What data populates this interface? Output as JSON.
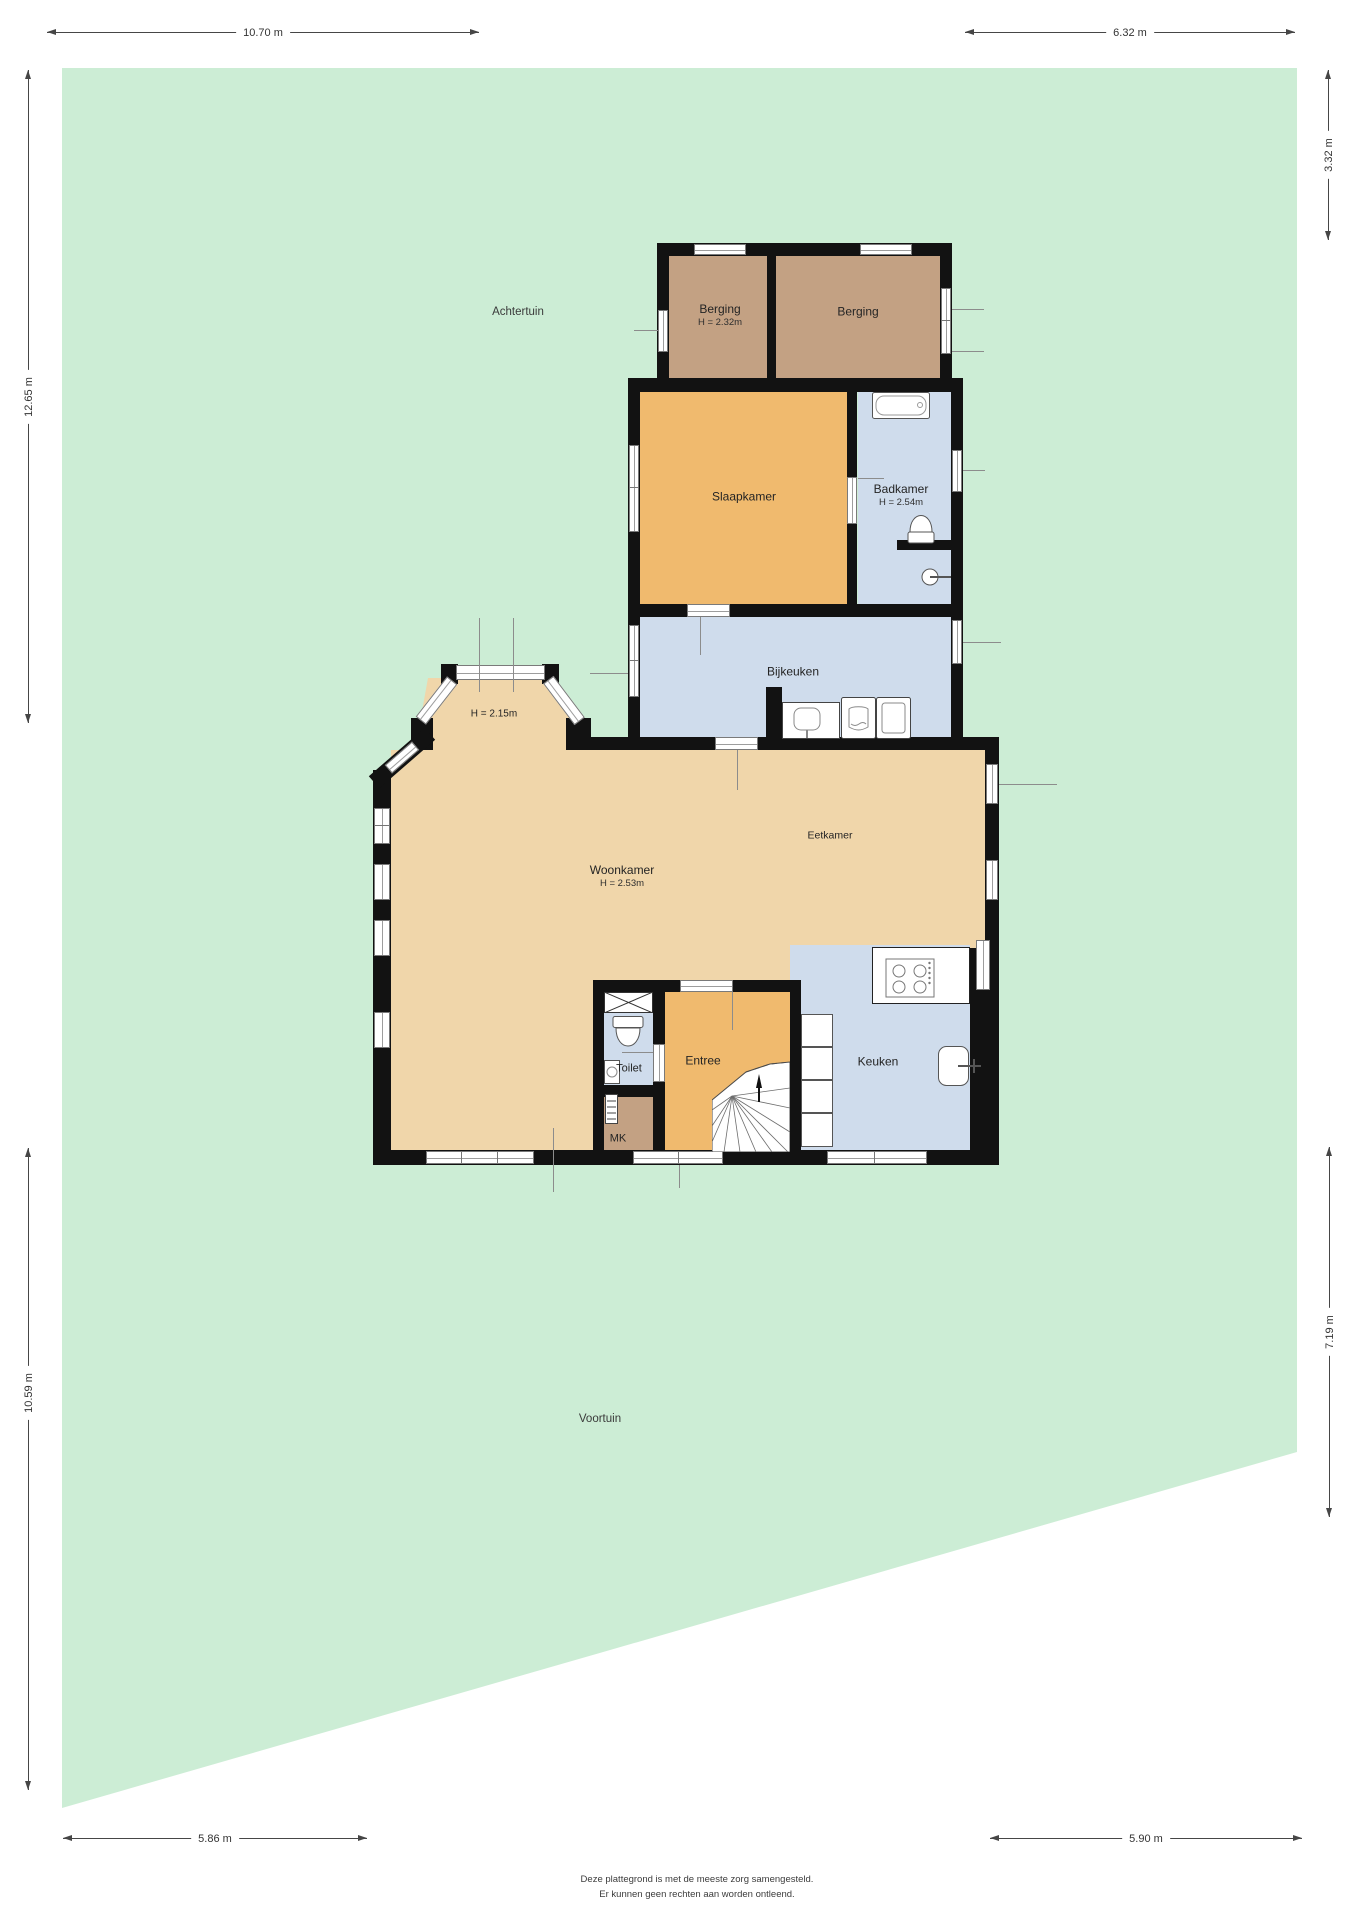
{
  "dimensions": {
    "top_left": "10.70 m",
    "top_right": "6.32 m",
    "left_upper": "12.65 m",
    "left_lower": "10.59 m",
    "right_upper": "3.32 m",
    "right_lower": "7.19 m",
    "bottom_left": "5.86 m",
    "bottom_right": "5.90 m"
  },
  "garden": {
    "back_label": "Achtertuin",
    "front_label": "Voortuin",
    "color": "#ccedd5"
  },
  "rooms": {
    "berging_left": {
      "name": "Berging",
      "height": "H = 2.32m"
    },
    "berging_right": {
      "name": "Berging"
    },
    "slaapkamer": {
      "name": "Slaapkamer"
    },
    "badkamer": {
      "name": "Badkamer",
      "height": "H = 2.54m"
    },
    "bijkeuken": {
      "name": "Bijkeuken"
    },
    "erker": {
      "height": "H = 2.15m"
    },
    "woonkamer": {
      "name": "Woonkamer",
      "height": "H = 2.53m"
    },
    "eetkamer": {
      "name": "Eetkamer"
    },
    "toilet": {
      "name": "Toilet"
    },
    "entree": {
      "name": "Entree"
    },
    "keuken": {
      "name": "Keuken"
    },
    "meterkast": {
      "name": "MK"
    }
  },
  "colors": {
    "garden": "#ccedd5",
    "living_floor": "#f0d6aa",
    "bedroom_floor": "#f0ba6e",
    "storage_floor": "#c3a183",
    "wet_room_floor": "#cfdcec",
    "wall": "#121212"
  },
  "footer": {
    "line1": "Deze plattegrond is met de meeste zorg samengesteld.",
    "line2": "Er kunnen geen rechten aan worden ontleend."
  }
}
